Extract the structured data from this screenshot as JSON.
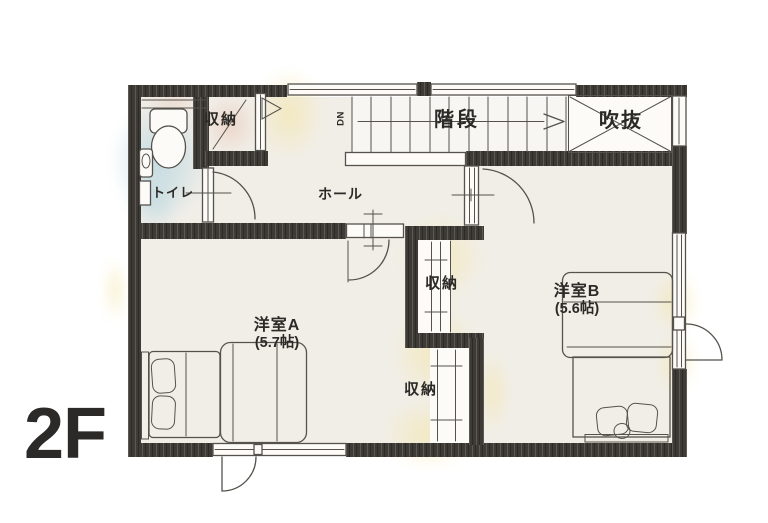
{
  "floor_indicator": "2F",
  "rooms": {
    "toilet": {
      "label": "トイレ"
    },
    "closet_top_left": {
      "label": "収納"
    },
    "stairs": {
      "label": "階段",
      "down_label": "DN"
    },
    "void": {
      "label": "吹抜"
    },
    "hall": {
      "label": "ホール"
    },
    "western_room_a": {
      "label": "洋室A",
      "size": "(5.7帖)"
    },
    "western_room_b": {
      "label": "洋室B",
      "size": "(5.6帖)"
    },
    "closet_middle": {
      "label": "収納"
    },
    "closet_lower": {
      "label": "収納"
    }
  },
  "colors": {
    "paper": "#ffffff",
    "floor": "#f1eee8",
    "floor_light": "#f7f6f2",
    "wall": "#3e3a35",
    "line": "#55524c",
    "text": "#2c2a27",
    "label_dark": "#2b2a28",
    "wash_blue": "#b7d6e0",
    "wash_pink": "#eacfbf",
    "wash_yellow": "#f3e6a9"
  }
}
